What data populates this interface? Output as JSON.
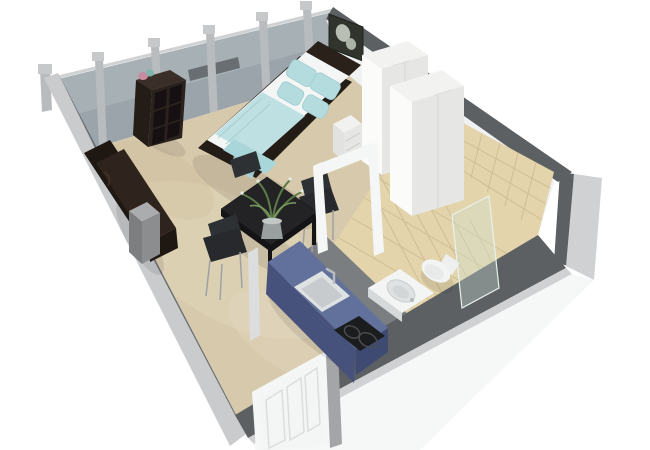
{
  "meta": {
    "title": "3D isometric cutaway floor plan render of a studio apartment",
    "type": "architectural-visualization",
    "projection": "overhead three-quarter isometric, walls cut away, white background"
  },
  "rooms": {
    "living_sleeping": {
      "label": "combined living and sleeping area",
      "floor": "beige carpet",
      "back_wall": "full-height glazed window wall with gray mullion posts",
      "furniture": [
        "double bed with dark frame, white mattress, aqua blanket and four aqua pillows",
        "dark picture with white flower above headboard",
        "white two-unit wardrobe",
        "white nightstand with drawers",
        "dark brown daybed sofa along left wall",
        "brushed metal side pedestal",
        "dark brown 2x3 cube shelving unit with pink and teal decor objects",
        "black square dining table with potted green plant centerpiece",
        "three dark dining chairs with thin metal legs"
      ]
    },
    "kitchen": {
      "label": "kitchenette",
      "furniture": [
        "blue kitchen counter block",
        "inset square sink with faucet",
        "black two-burner cooktop"
      ]
    },
    "bathroom": {
      "label": "bathroom",
      "finishes": "beige ceramic tile floor and wall",
      "furniture": [
        "white toilet",
        "square white washbasin",
        "glass shower partition"
      ]
    },
    "entry": {
      "label": "entry",
      "furniture": [
        "white paneled entrance door in front wall",
        "open white interior door frame"
      ]
    }
  },
  "colors": {
    "background": "#ffffff",
    "wall_top_dark": "#5d6063",
    "wall_outer_light": "#c9cbcd",
    "wall_inner_gray": "#696c6f",
    "wall_white_face": "#f0f1f2",
    "wall_exterior_white": "#f6f7f7",
    "wall_stripe_light": "#cfd1d3",
    "glass_wall": "#9ba4aa",
    "glass_sheen": "#b3bbc0",
    "glass_reflection": "#34383a",
    "mullion": "#b9bcbe",
    "mullion_cap": "#c6c8ca",
    "carpet": "#d7c9ab",
    "carpet_light": "#e6dcc4",
    "carpet_dark": "#c8b795",
    "tile": "#e4d4ab",
    "tile_grout": "#c9b88e",
    "partition_gray": "#7b7e80",
    "counter_top": "#62719c",
    "counter_side": "#47527c",
    "counter_end": "#535f8a",
    "counter_end_dark": "#3f4a72",
    "sink_rim": "#dfe2e3",
    "sink_basin": "#c7cbcd",
    "cooktop": "#1b1c1e",
    "burner_ring": "#4a4c4f",
    "bed_frame": "#241c16",
    "headboard": "#2a211b",
    "mattress": "#f4f5f5",
    "blanket": "#bfe0e2",
    "blanket_dark": "#a9d6d8",
    "pillow": "#b4dcdf",
    "wardrobe_top": "#f2f2f0",
    "wardrobe_left": "#fbfbf9",
    "wardrobe_front": "#e6e6e4",
    "nightstand": "#f1f1ef",
    "picture_bg": "#30342d",
    "picture_flower": "#c8cdc2",
    "sofa": "#2f241d",
    "sofa_dark": "#1f1712",
    "pedestal_light": "#aaacae",
    "pedestal_mid": "#8b8d8f",
    "pedestal_dark": "#7c7e80",
    "shelf_top": "#3a2f28",
    "shelf_body": "#2b221d",
    "shelf_side": "#241c16",
    "shelf_cubby": "#161013",
    "table_top": "#232326",
    "table_side": "#141416",
    "chair": "#2e3134",
    "chair_seat": "#27292c",
    "chair_leg": "#9fa1a4",
    "plant_green": "#5d7a47",
    "plant_green_light": "#7d9c60",
    "flower_white": "#e8ece4",
    "pot": "#9aa0a0",
    "pot_rim": "#c2c7c7",
    "door_white": "#f4f5f5",
    "door_frame_gray": "#a3a5a7",
    "doorframe_white": "#f5f6f6",
    "jamb_light": "#dcdddf",
    "fixture_white": "#f3f4f4",
    "fixture_shadow": "#d6d9d9",
    "basin_inner": "#dfe2e2",
    "glass_shower": "#cfe3d8",
    "deco_pink": "#c98ba0",
    "deco_teal": "#7fb5ad"
  }
}
